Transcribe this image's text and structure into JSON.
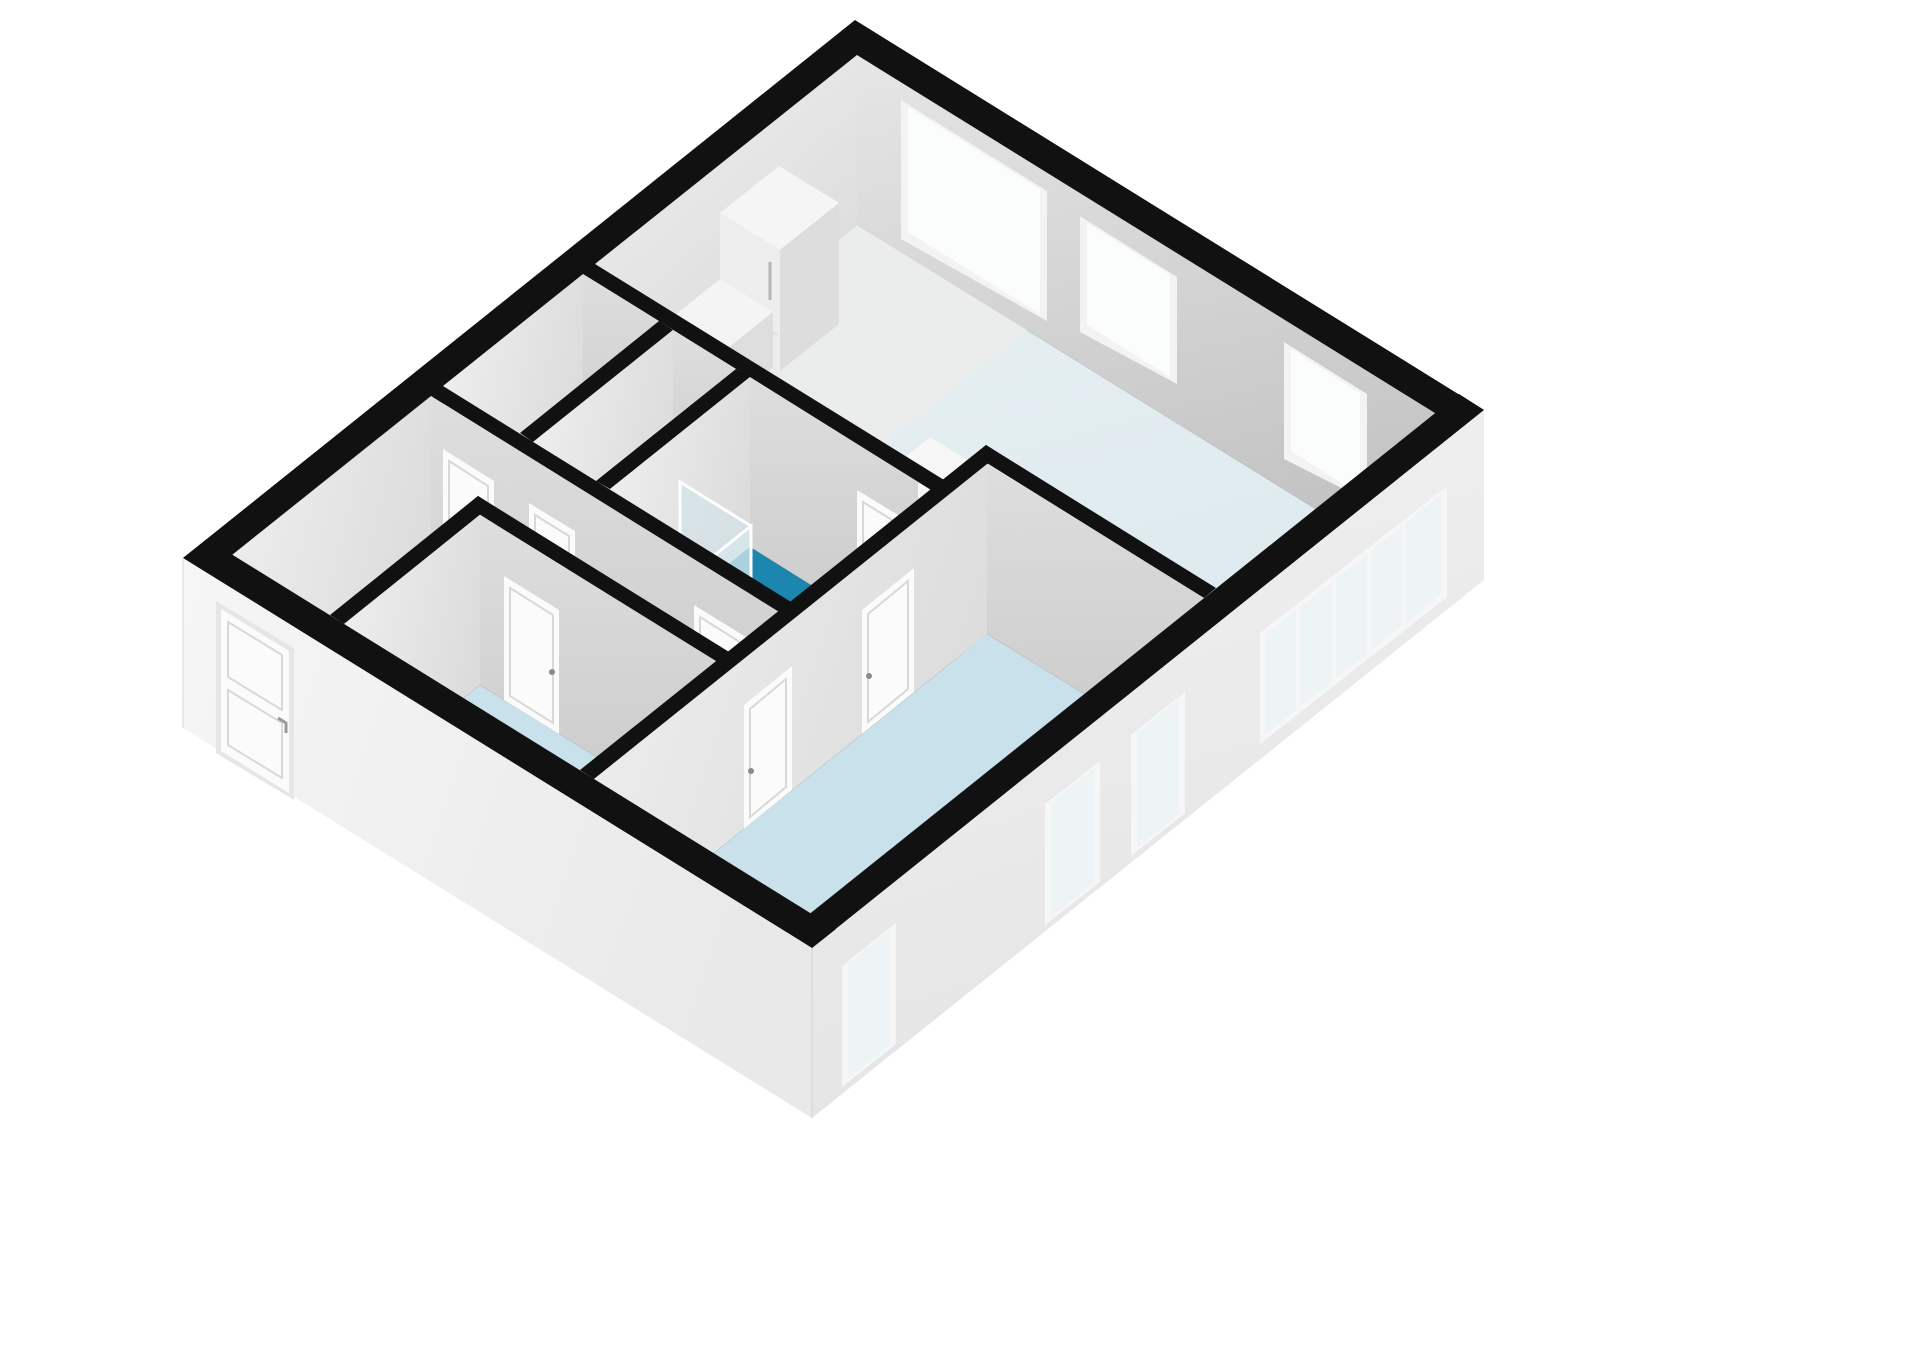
{
  "scene": {
    "kind": "3d-floorplan-render",
    "view": "isometric cutaway, no text labels",
    "background": "#ffffff"
  },
  "palette": {
    "wall_cut": "#111111",
    "ne_face_a": "#e2e2e2",
    "ne_face_b": "#c7c7c7",
    "nw_face": "#ebebeb",
    "inner_face": "#d8d8d8",
    "inner_face_dark": "#c6c6c6",
    "side_face": "#e9e9e9",
    "exterior_se": "#ededed",
    "exterior_sw": "#f2f2f2",
    "living_floor": "#e4eef1",
    "kitchen_floor": "#ebecec",
    "hall_floor": "#e9eaea",
    "bedroom_floor": "#c9e1ea",
    "bathroom_floor": "#1d86ae",
    "glass": "#eef4f6",
    "glass_bright": "#fbfdfd",
    "fixture": "#fbfbfb",
    "frame": "#f3f3f3",
    "handle": "#8a8a8a"
  },
  "inventory": {
    "rooms_visible": 7,
    "ne_wall_windows": 3,
    "se_glazed_panes": 5,
    "se_windows": 3,
    "interior_doors": 8,
    "front_doors": 1,
    "fixtures": [
      "refrigerator-unit",
      "kitchen-counter",
      "kitchen-island",
      "bathroom-sink",
      "shower-screen",
      "toilet"
    ]
  }
}
